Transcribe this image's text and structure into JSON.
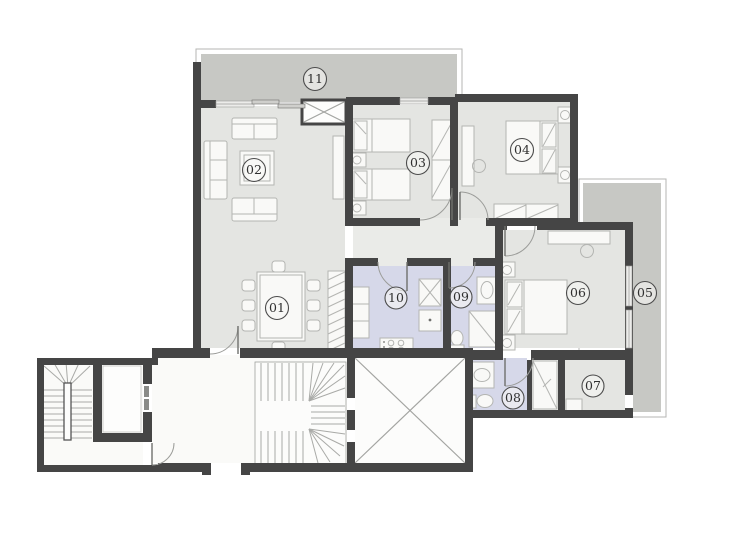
{
  "plan": {
    "type": "apartment-floor-plan",
    "rooms": [
      {
        "id": "room-01",
        "label": "01"
      },
      {
        "id": "room-02",
        "label": "02"
      },
      {
        "id": "room-03",
        "label": "03"
      },
      {
        "id": "room-04",
        "label": "04"
      },
      {
        "id": "room-05",
        "label": "05"
      },
      {
        "id": "room-06",
        "label": "06"
      },
      {
        "id": "room-07",
        "label": "07"
      },
      {
        "id": "room-08",
        "label": "08"
      },
      {
        "id": "room-09",
        "label": "09"
      },
      {
        "id": "room-10",
        "label": "10"
      },
      {
        "id": "room-11",
        "label": "11"
      }
    ],
    "colors": {
      "wall": "#454545",
      "room_floor": "#e4e5e2",
      "hall_floor": "#eaebe8",
      "wet_floor": "#d6d8e9",
      "shower_floor": "#f2f2f0",
      "balcony_floor": "#c7c8c4",
      "common_floor": "#fafaf8",
      "shaft_floor": "#fcfcfb",
      "label_ink": "#2f2f2f"
    }
  }
}
